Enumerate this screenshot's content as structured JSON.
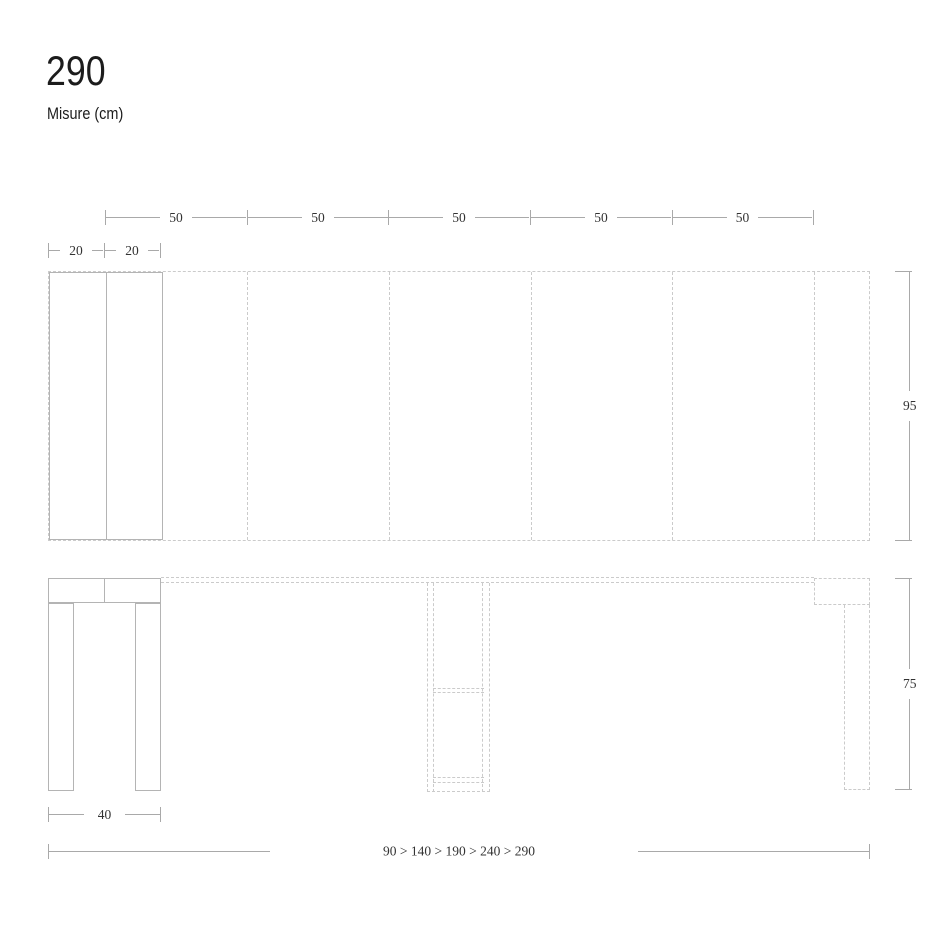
{
  "header": {
    "title": "290",
    "subtitle": "Misure (cm)"
  },
  "top_view": {
    "width_segments": [
      "50",
      "50",
      "50",
      "50",
      "50"
    ],
    "left_segments": [
      "20",
      "20"
    ],
    "depth": "95"
  },
  "front_view": {
    "height": "75",
    "closed_width": "40",
    "extensions": "90 > 140 > 190 > 240 > 290"
  },
  "colors": {
    "background": "#ffffff",
    "drawing_line": "#b4b4b4",
    "dashed_line": "#cbcbcb",
    "dimension_line": "#a9a9a9",
    "dimension_text": "#333333",
    "title_text": "#1c1c1c"
  }
}
